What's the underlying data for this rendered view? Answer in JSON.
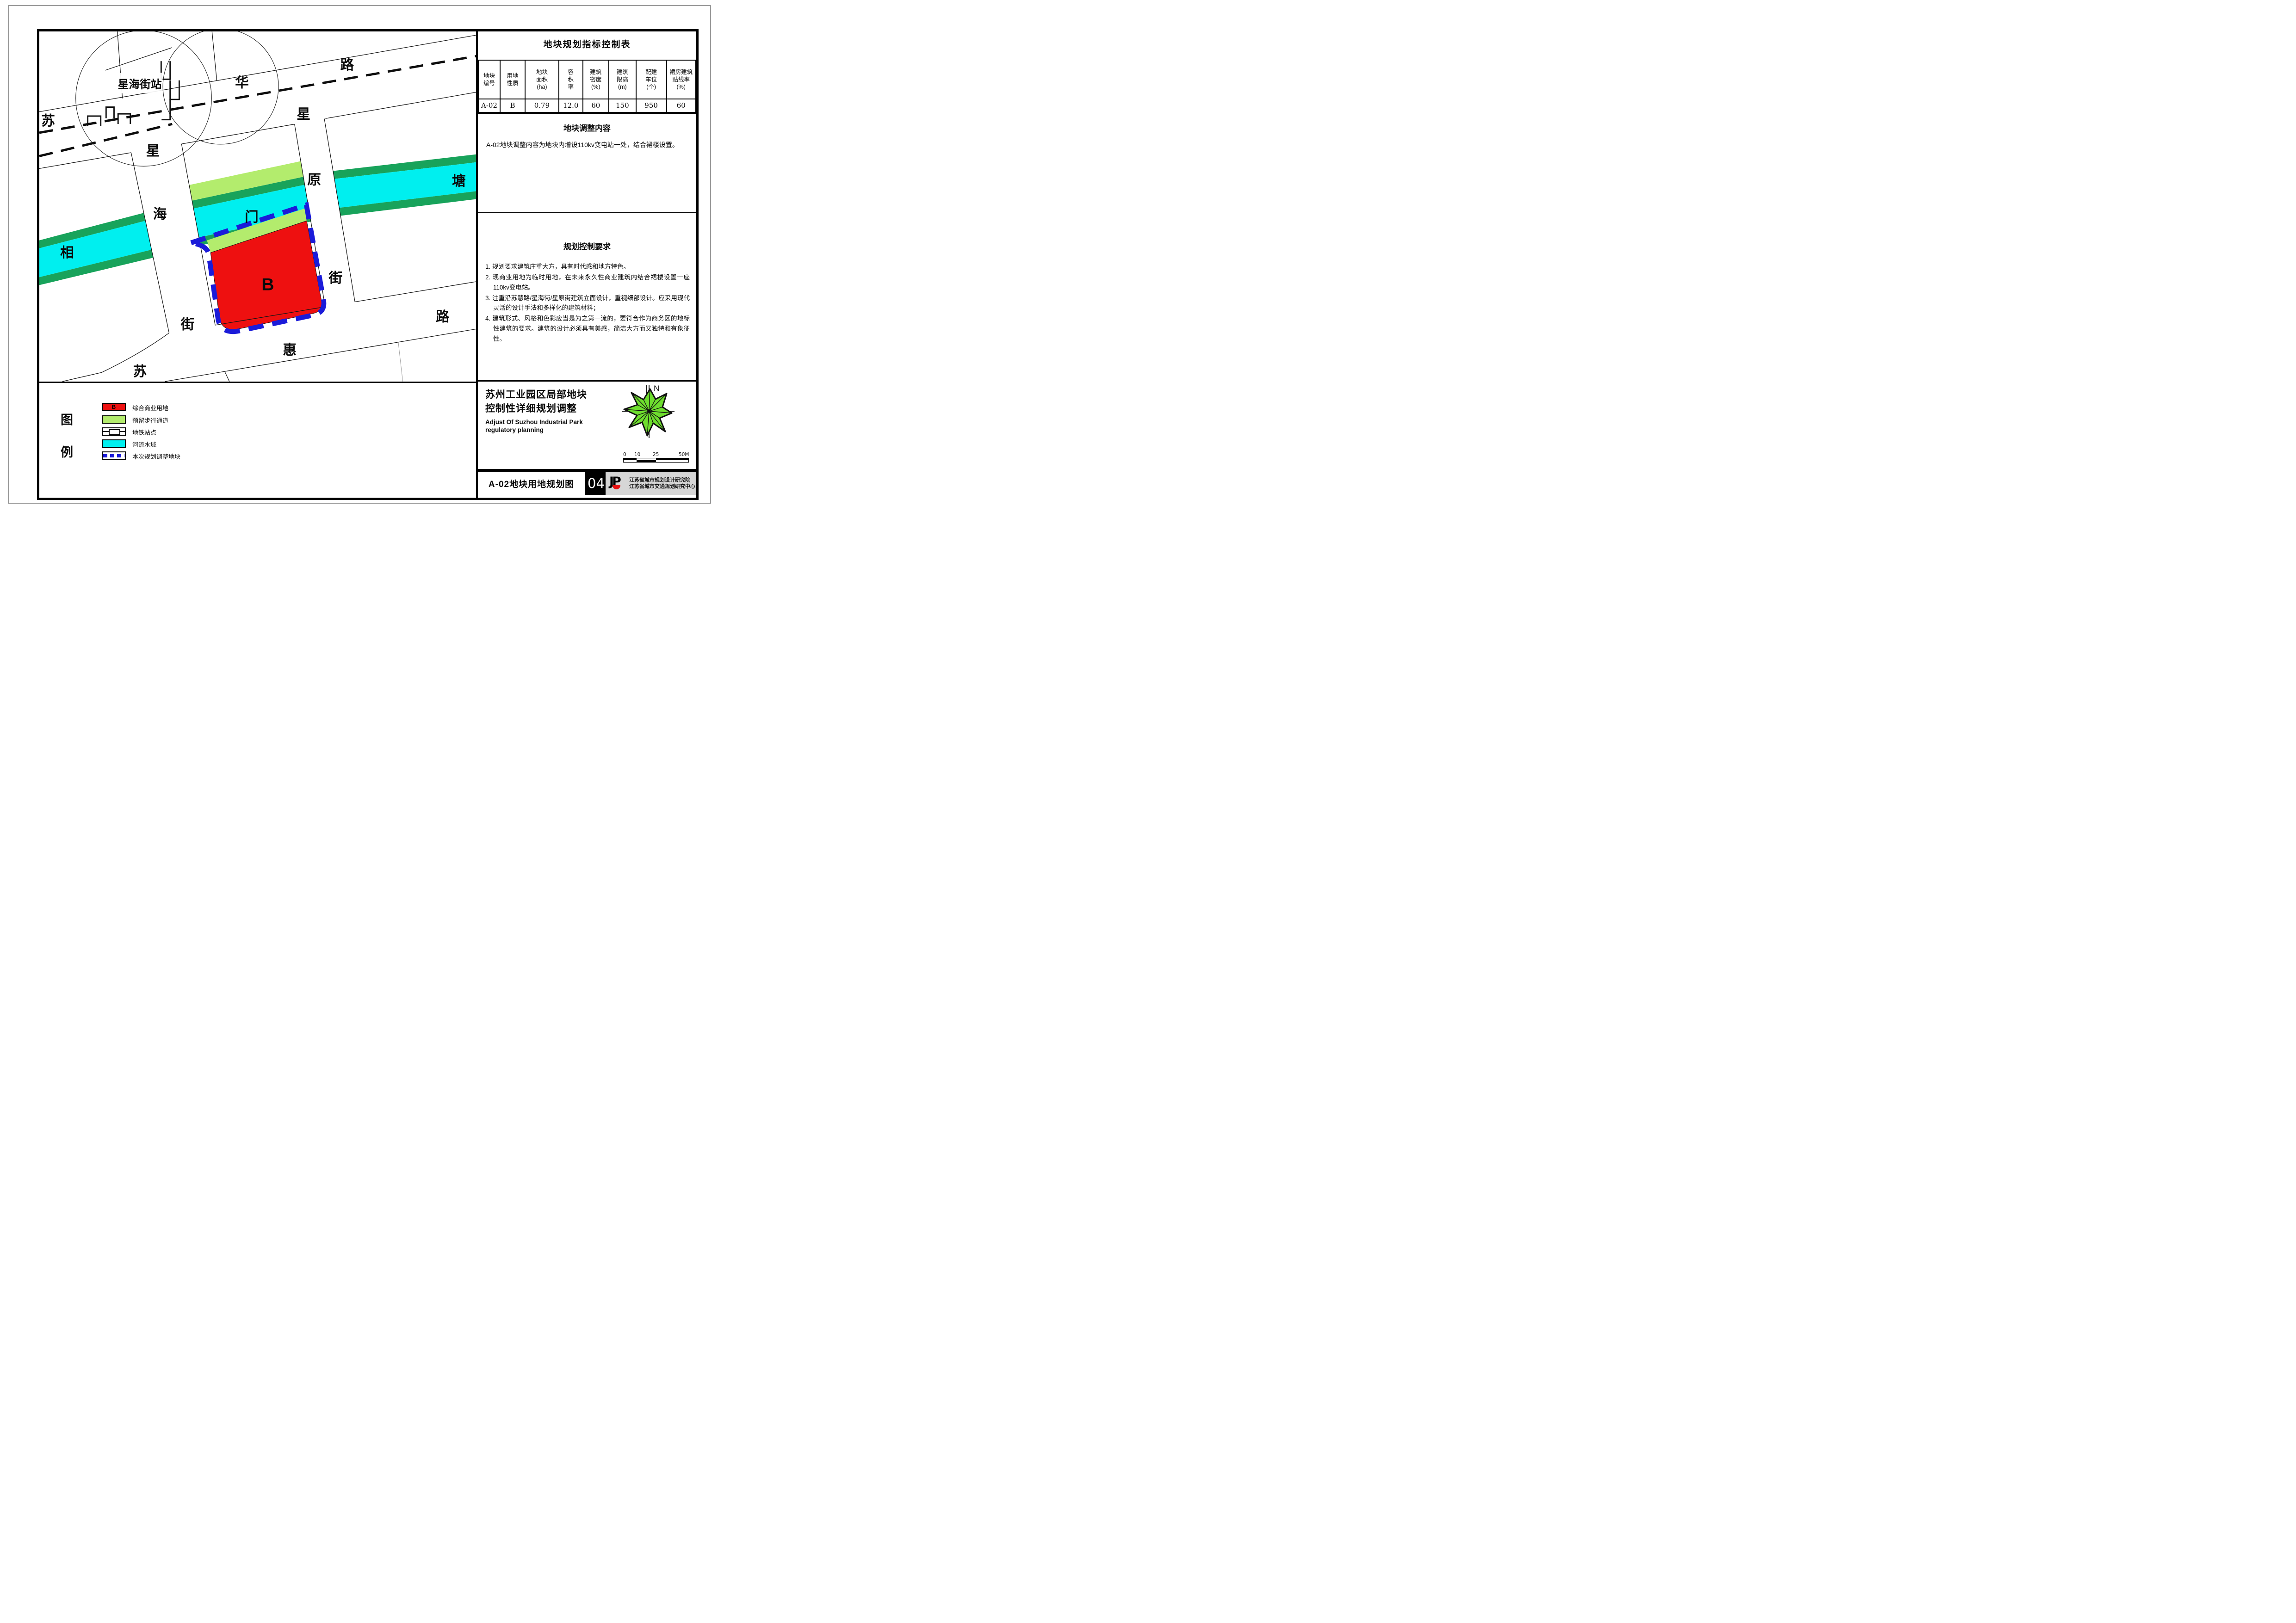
{
  "table": {
    "title": "地块规划指标控制表",
    "headers": [
      [
        "地块",
        "编号"
      ],
      [
        "用地",
        "性质"
      ],
      [
        "地块",
        "面积",
        "(ha)"
      ],
      [
        "容",
        "积",
        "率"
      ],
      [
        "建筑",
        "密度",
        "(%)"
      ],
      [
        "建筑",
        "限高",
        "(m)"
      ],
      [
        "配建",
        "车位",
        "(个)"
      ],
      [
        "裙房建筑",
        "贴线率",
        "(%)"
      ]
    ],
    "row": [
      "A-02",
      "B",
      "0.79",
      "12.0",
      "60",
      "150",
      "950",
      "60"
    ]
  },
  "adjust_section": {
    "title": "地块调整内容",
    "body": "A-02地块调整内容为地块内增设110kv变电站一处，结合裙楼设置。"
  },
  "control_section": {
    "title": "规划控制要求",
    "items": [
      "1. 规划要求建筑庄重大方，具有时代感和地方特色。",
      "2. 现商业用地为临时用地，在未来永久性商业建筑内结合裙楼设置一座110kv变电站。",
      "3. 注重沿苏慧路/星海街/星原街建筑立面设计，重视细部设计。应采用现代灵活的设计手法和多样化的建筑材料；",
      "4. 建筑形式、风格和色彩应当是为之第一流的，要符合作为商务区的地标性建筑的要求。建筑的设计必须具有美感，简洁大方而又独特和有象征性。"
    ]
  },
  "title_block": {
    "title_line1": "苏州工业园区局部地块",
    "title_line2": "控制性详细规划调整",
    "subtitle_line1": "Adjust Of Suzhou Industrial Park",
    "subtitle_line2": "regulatory planning",
    "north_label": "N",
    "scale_ticks": [
      "0",
      "10",
      "25",
      "50M"
    ]
  },
  "bottom_bar": {
    "drawing_title": "A-02地块用地规划图",
    "sheet_number": "04",
    "logo_text": "JP",
    "org_line1": "江苏省城市规划设计研究院",
    "org_line2": "江苏省城市交通规划研究中心"
  },
  "legend": {
    "label_char1": "图",
    "label_char2": "例",
    "items": [
      {
        "badge": "B",
        "label": "综合商业用地"
      },
      {
        "label": "预留步行通道"
      },
      {
        "label": "地铁站点"
      },
      {
        "label": "河流水域"
      },
      {
        "label": "本次规划调整地块"
      }
    ]
  },
  "map": {
    "labels": {
      "station": "星海街站",
      "parcel": "B",
      "su_top": "苏",
      "hua": "华",
      "lu_top": "路",
      "xing_hai": "星",
      "hai": "海",
      "jie_hai": "街",
      "xing_yuan": "星",
      "yuan": "原",
      "jie_yuan": "街",
      "xiang": "相",
      "men": "门",
      "tang": "塘",
      "su_bottom": "苏",
      "hui": "惠",
      "lu_bottom": "路"
    },
    "colors": {
      "commercial_red": "#ee1010",
      "pedestrian_green": "#b3ec6d",
      "river_cyan": "#00efef",
      "river_bank_green": "#18a35b",
      "boundary_blue": "#1b1bd9"
    }
  }
}
